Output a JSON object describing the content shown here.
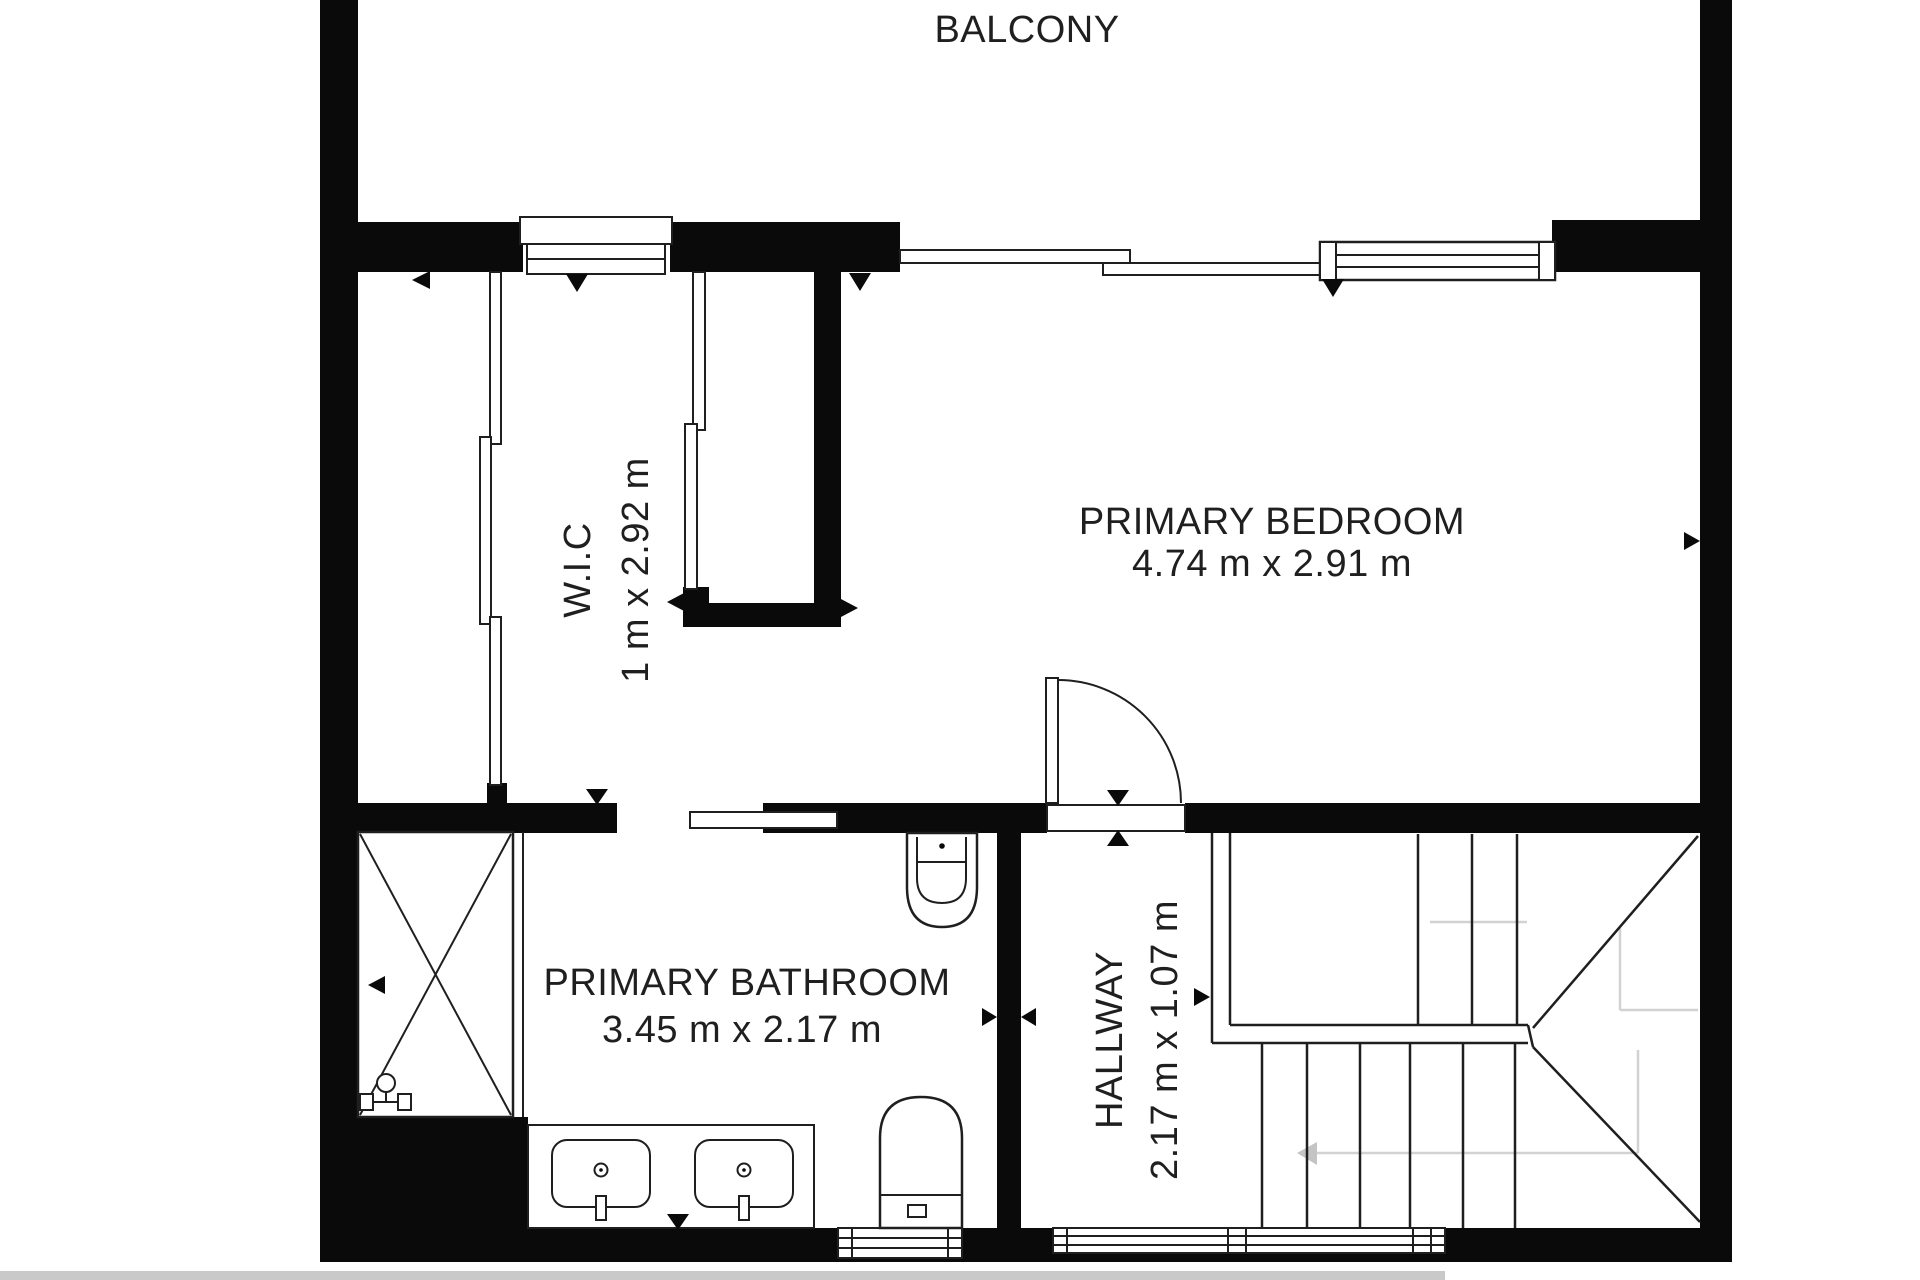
{
  "plan": {
    "title": "Upper floor plan",
    "rooms": {
      "balcony": {
        "name": "BALCONY",
        "dims": ""
      },
      "wic": {
        "name": "W.I.C",
        "dims": "1 m x 2.92 m"
      },
      "bedroom": {
        "name": "PRIMARY BEDROOM",
        "dims": "4.74 m x 2.91 m"
      },
      "bathroom": {
        "name": "PRIMARY BATHROOM",
        "dims": "3.45 m x 2.17 m"
      },
      "hallway": {
        "name": "HALLWAY",
        "dims": "2.17 m x 1.07 m"
      }
    },
    "fixtures": [
      "shower",
      "double-vanity-sinks",
      "toilet",
      "bidet",
      "staircase-with-winders",
      "hinged-door",
      "sliding-doors",
      "windows",
      "balcony-sliding-glass"
    ],
    "colors": {
      "wall": "#0a0a0a",
      "line": "#1f1f1f",
      "text": "#1f1f1f",
      "faint_guide": "#d2d2d2",
      "photo_edge": "#c9c9c9",
      "background": "#ffffff"
    }
  }
}
